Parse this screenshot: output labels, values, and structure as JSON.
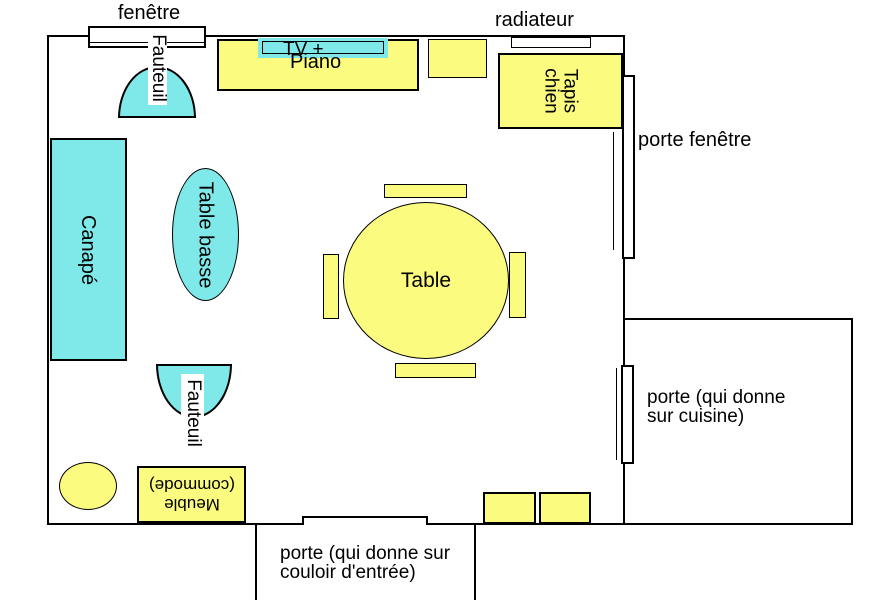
{
  "colors": {
    "cyan": "#7fe9e9",
    "yellow": "#fbfb80",
    "wall": "#000000",
    "background": "#ffffff"
  },
  "room": {
    "window_label": "fenêtre",
    "radiator_label": "radiateur",
    "french_door_label": "porte fenêtre",
    "kitchen_door_label_line1": "porte (qui donne",
    "kitchen_door_label_line2": "sur cuisine)",
    "hall_door_label_line1": "porte (qui donne sur",
    "hall_door_label_line2": "couloir d'entrée)"
  },
  "furniture": {
    "armchair_top": "Fauteuil",
    "armchair_bottom": "Fauteuil",
    "sofa": "Canapé",
    "coffee_table": "Table basse",
    "tv": "TV +",
    "piano": "Piano",
    "dog_rug_line1": "Tapis",
    "dog_rug_line2": "chien",
    "dining_table": "Table",
    "cabinet_line1": "Meuble",
    "cabinet_line2": "(commode)"
  }
}
